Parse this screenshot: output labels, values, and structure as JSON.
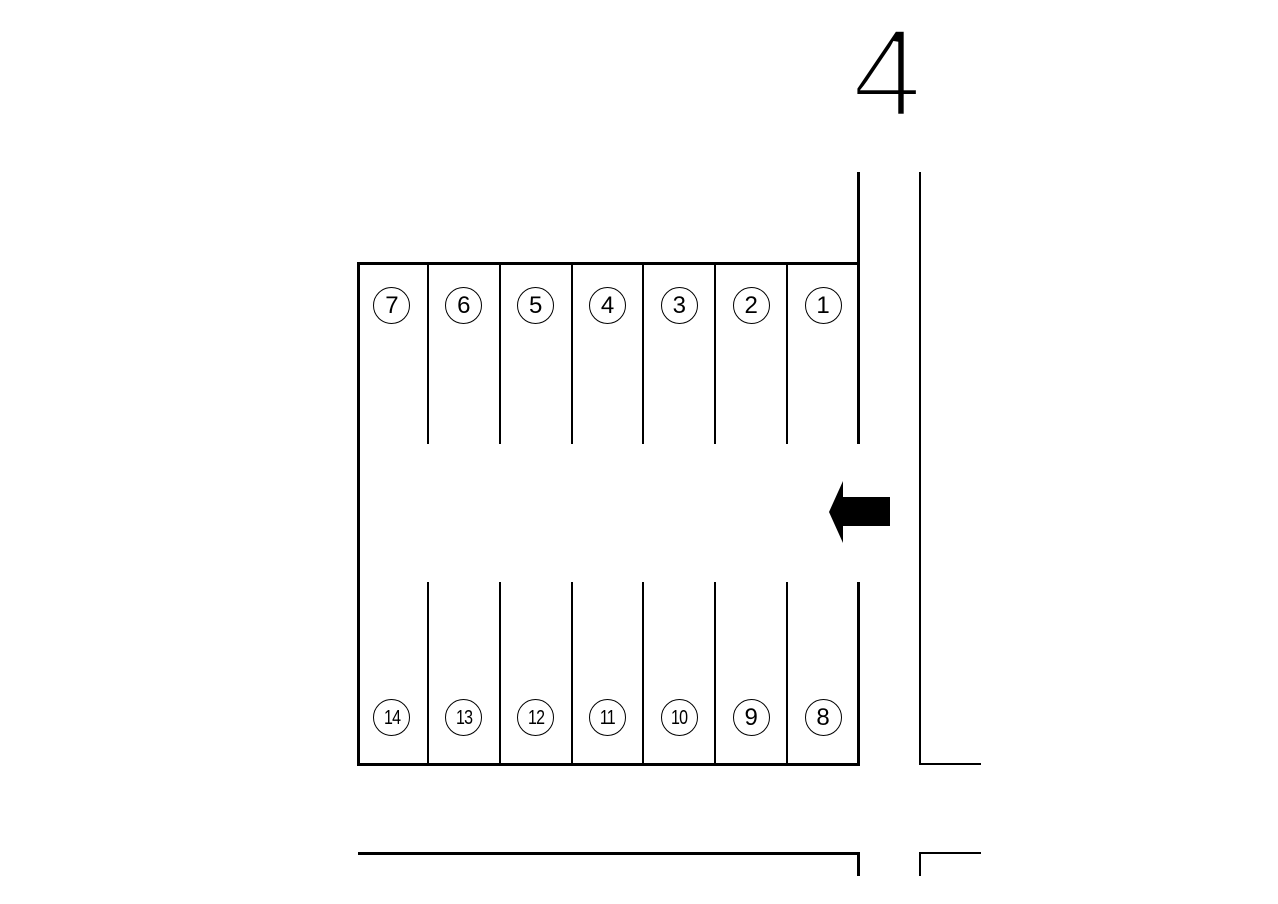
{
  "road": {
    "number_label": "4"
  },
  "parking_lot": {
    "top_row_labels": [
      "7",
      "6",
      "5",
      "4",
      "3",
      "2",
      "1"
    ],
    "bottom_row_labels": [
      "14",
      "13",
      "12",
      "11",
      "10",
      "9",
      "8"
    ]
  },
  "entrance_arrow": {
    "direction": "left"
  },
  "colors": {
    "background": "#ffffff",
    "line": "#000000",
    "arrow_fill": "#000000"
  }
}
